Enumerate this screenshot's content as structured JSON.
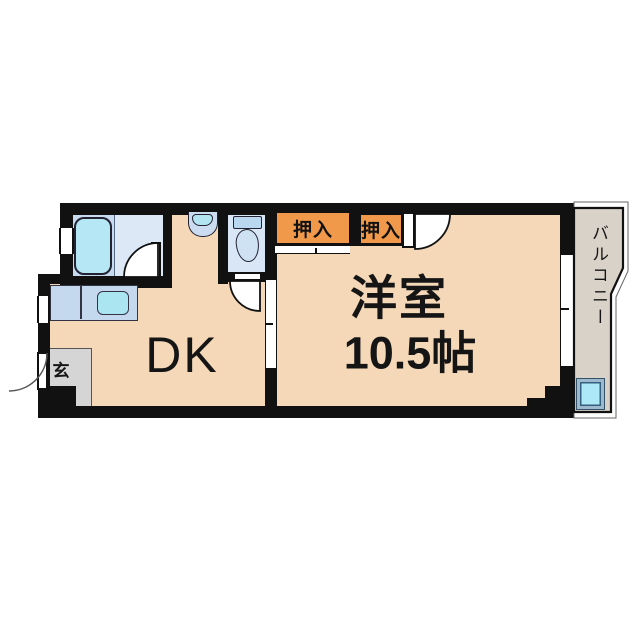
{
  "floorplan": {
    "rooms": {
      "dk": {
        "label": "DK"
      },
      "western_room": {
        "label": "洋室",
        "size": "10.5帖"
      },
      "closet_left": {
        "label": "押入"
      },
      "closet_right": {
        "label": "押入"
      },
      "entrance": {
        "label": "玄"
      },
      "balcony": {
        "label": "バルコニー"
      }
    },
    "fixtures": [
      {
        "name": "bathtub-icon"
      },
      {
        "name": "kitchen-counter-icon"
      },
      {
        "name": "kitchen-sink-icon"
      },
      {
        "name": "washbasin-icon"
      },
      {
        "name": "toilet-icon"
      },
      {
        "name": "washing-machine-pan-icon"
      }
    ],
    "colors": {
      "wall": "#111111",
      "room_floor": "#f5d8b8",
      "closet_fill": "#f0994a",
      "wet_area_floor": "#d9e6f5",
      "bath_floor": "#c7daef",
      "fixture_water": "#abe5f2",
      "balcony_floor": "#d9d2c9",
      "entrance_floor": "#d5d5d5"
    }
  }
}
